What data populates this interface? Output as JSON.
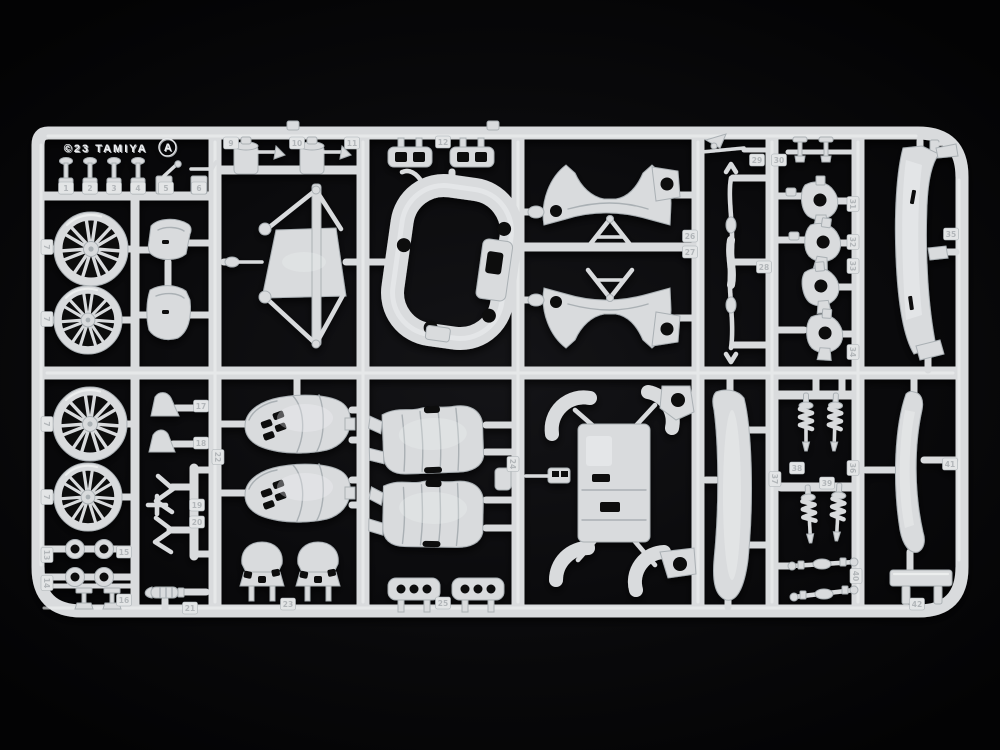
{
  "scene": {
    "subject": "white plastic model kit parts sprue photographed on black background"
  },
  "branding": {
    "copyright": "©23 TAMIYA",
    "sprue_letter": "A"
  },
  "colors": {
    "background": "#0a0a0c",
    "plastic": "#d9dbdd",
    "plastic-light": "#f0f2f3",
    "plastic-dark": "#aab0b4",
    "hole": "#0a0a0c",
    "tag-fill": "#e3e5e6",
    "tag-text": "#b2b6b9",
    "emboss-dark": "#a8abae",
    "emboss-light": "#eef0f2"
  },
  "gate_tags": [
    {
      "label": "1",
      "x": 66,
      "y": 188,
      "r": 0
    },
    {
      "label": "2",
      "x": 90,
      "y": 188,
      "r": 0
    },
    {
      "label": "3",
      "x": 114,
      "y": 188,
      "r": 0
    },
    {
      "label": "4",
      "x": 138,
      "y": 188,
      "r": 0
    },
    {
      "label": "5",
      "x": 166,
      "y": 188,
      "r": 0
    },
    {
      "label": "6",
      "x": 199,
      "y": 188,
      "r": 0
    },
    {
      "label": "7",
      "x": 47,
      "y": 247,
      "r": 90
    },
    {
      "label": "7",
      "x": 47,
      "y": 319,
      "r": 90
    },
    {
      "label": "7",
      "x": 47,
      "y": 424,
      "r": 90
    },
    {
      "label": "7",
      "x": 47,
      "y": 497,
      "r": 90
    },
    {
      "label": "9",
      "x": 231,
      "y": 143,
      "r": 0
    },
    {
      "label": "10",
      "x": 297,
      "y": 143,
      "r": 0
    },
    {
      "label": "11",
      "x": 352,
      "y": 143,
      "r": 0
    },
    {
      "label": "12",
      "x": 443,
      "y": 142,
      "r": 0
    },
    {
      "label": "13",
      "x": 47,
      "y": 555,
      "r": 90
    },
    {
      "label": "14",
      "x": 47,
      "y": 583,
      "r": 90
    },
    {
      "label": "15",
      "x": 124,
      "y": 552,
      "r": 0
    },
    {
      "label": "16",
      "x": 124,
      "y": 600,
      "r": 0
    },
    {
      "label": "17",
      "x": 201,
      "y": 406,
      "r": 0
    },
    {
      "label": "18",
      "x": 201,
      "y": 443,
      "r": 0
    },
    {
      "label": "19",
      "x": 197,
      "y": 505,
      "r": 0
    },
    {
      "label": "20",
      "x": 197,
      "y": 522,
      "r": 0
    },
    {
      "label": "21",
      "x": 190,
      "y": 608,
      "r": 0
    },
    {
      "label": "22",
      "x": 218,
      "y": 457,
      "r": 90
    },
    {
      "label": "23",
      "x": 288,
      "y": 604,
      "r": 0
    },
    {
      "label": "24",
      "x": 513,
      "y": 464,
      "r": 90
    },
    {
      "label": "25",
      "x": 443,
      "y": 603,
      "r": 0
    },
    {
      "label": "26",
      "x": 690,
      "y": 236,
      "r": 0
    },
    {
      "label": "27",
      "x": 690,
      "y": 252,
      "r": 0
    },
    {
      "label": "28",
      "x": 764,
      "y": 267,
      "r": 0
    },
    {
      "label": "29",
      "x": 757,
      "y": 160,
      "r": 0
    },
    {
      "label": "30",
      "x": 779,
      "y": 160,
      "r": 0
    },
    {
      "label": "31",
      "x": 853,
      "y": 204,
      "r": 90
    },
    {
      "label": "32",
      "x": 853,
      "y": 242,
      "r": 90
    },
    {
      "label": "33",
      "x": 853,
      "y": 266,
      "r": 90
    },
    {
      "label": "34",
      "x": 853,
      "y": 352,
      "r": 90
    },
    {
      "label": "35",
      "x": 951,
      "y": 234,
      "r": 0
    },
    {
      "label": "36",
      "x": 853,
      "y": 468,
      "r": 90
    },
    {
      "label": "37",
      "x": 775,
      "y": 479,
      "r": 90
    },
    {
      "label": "38",
      "x": 797,
      "y": 468,
      "r": 0
    },
    {
      "label": "39",
      "x": 827,
      "y": 483,
      "r": 0
    },
    {
      "label": "40",
      "x": 856,
      "y": 576,
      "r": 90
    },
    {
      "label": "41",
      "x": 950,
      "y": 464,
      "r": 0
    },
    {
      "label": "42",
      "x": 917,
      "y": 604,
      "r": 0
    }
  ]
}
